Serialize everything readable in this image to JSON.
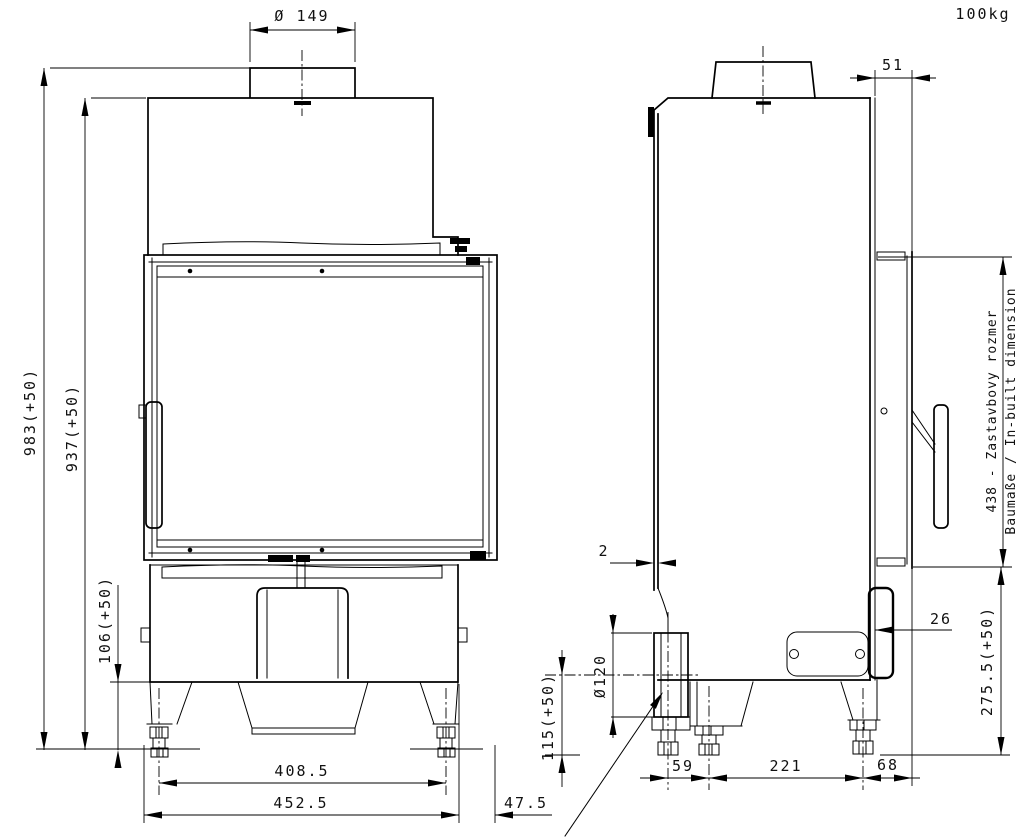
{
  "drawing": {
    "weight_label": "100kg",
    "front_view": {
      "flue_diameter": "Ø 149",
      "total_height": "983(+50)",
      "body_height": "937(+50)",
      "plinth_height": "106(+50)",
      "feet_spacing": "408.5",
      "body_width": "452.5",
      "door_overhang": "47.5"
    },
    "side_view": {
      "flue_offset": "51",
      "rear_wall_thickness": "2",
      "intake_diameter": "Ø120",
      "intake_axis_height": "115(+50)",
      "front_foot_offset": "59",
      "feet_spacing": "221",
      "rear_foot_offset": "68",
      "bracket_depth": "26",
      "lower_zone_height": "275.5(+50)",
      "inbuilt_dimension_value": "438 - Zastavbovy rozmer",
      "inbuilt_dimension_label": "Baumaße / In-built dimension"
    }
  }
}
